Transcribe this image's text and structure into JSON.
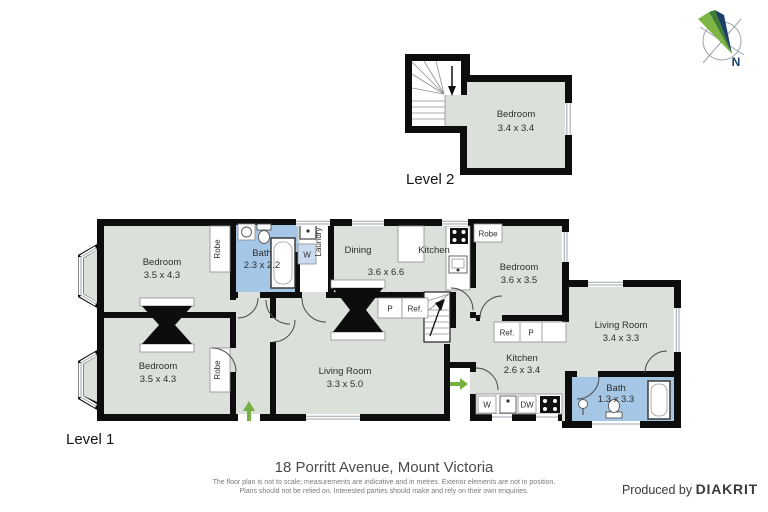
{
  "title": {
    "address": "18 Porritt Avenue, Mount Victoria"
  },
  "footer": {
    "disclaimer_line1": "The floor plan is not to scale; measurements are indicative and in metres. Exterior elements are not in position.",
    "disclaimer_line2": "Plans should not be relied on. Interested parties should make and rely on their own enquiries.",
    "credit_prefix": "Produced by",
    "credit_brand": "DIAKRIT"
  },
  "compass": {
    "label": "N"
  },
  "level2": {
    "label": "Level 2",
    "bedroom": {
      "name": "Bedroom",
      "dims": "3.4 x 3.4"
    }
  },
  "level1": {
    "label": "Level 1",
    "bedroom_tl": {
      "name": "Bedroom",
      "dims": "3.5 x 4.3"
    },
    "bath1": {
      "name": "Bath",
      "dims": "2.3 x 2.2"
    },
    "dining": {
      "name": "Dining",
      "dims": "3.6 x 6.6"
    },
    "kitchen_top": {
      "name": "Kitchen"
    },
    "bedroom_tr": {
      "name": "Bedroom",
      "dims": "3.6 x 3.5"
    },
    "bedroom_bl": {
      "name": "Bedroom",
      "dims": "3.5 x 4.3"
    },
    "living_main": {
      "name": "Living Room",
      "dims": "3.3 x 5.0"
    },
    "kitchen_br": {
      "name": "Kitchen",
      "dims": "2.6 x 3.4"
    },
    "living_wing": {
      "name": "Living Room",
      "dims": "3.4 x 3.3"
    },
    "bath2": {
      "name": "Bath",
      "dims": "1.3 x 3.3"
    }
  },
  "fixtures": {
    "robe": "Robe",
    "laundry": "Laundry",
    "washer": "W",
    "dishwasher": "DW",
    "pantry": "P",
    "fridge": "Ref."
  },
  "colors": {
    "room_fill": "#dbe1da",
    "bath_fill": "#a6c6e5",
    "washer_fill": "#c9dcef",
    "wall": "#0d0d0d",
    "accent_green": "#76b043",
    "compass_green": "#7fb544",
    "compass_green_dark": "#3f7d35",
    "compass_navy": "#1b3f66",
    "window_line": "#9aa4ab",
    "text_dark": "#2d2d2d"
  }
}
